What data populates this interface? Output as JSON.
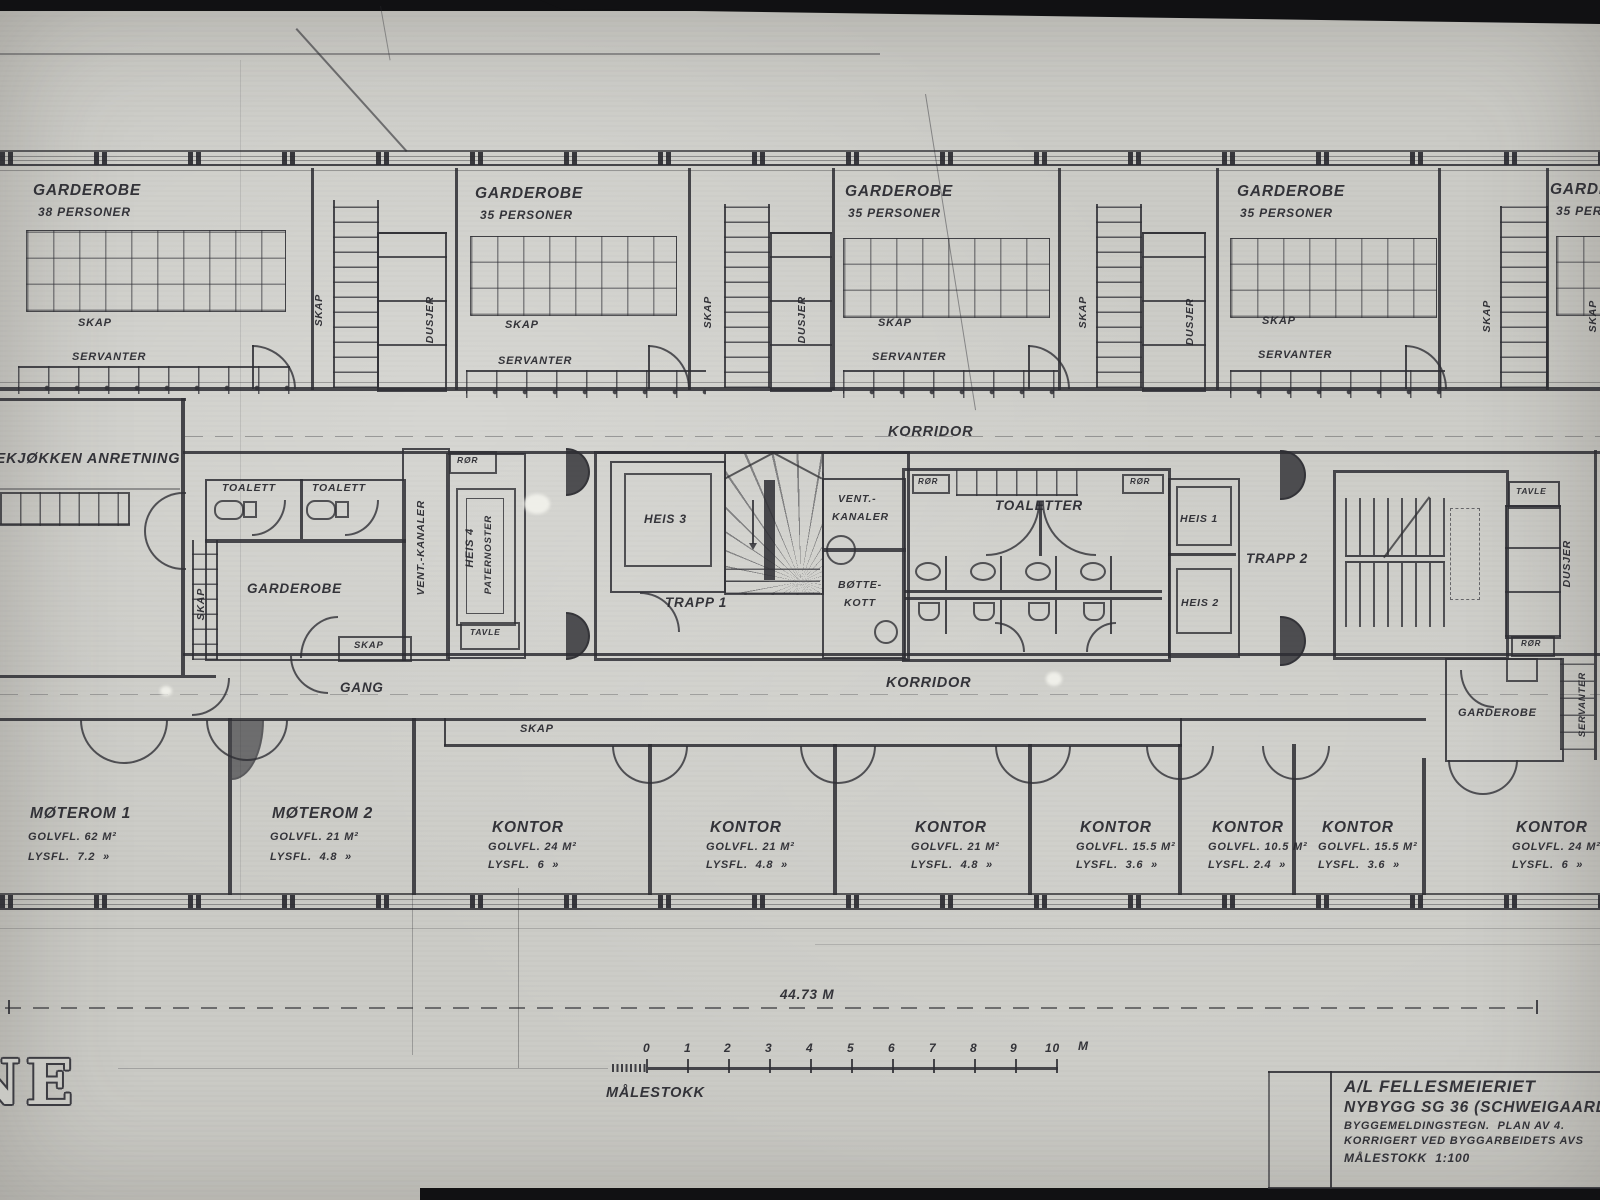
{
  "page": {
    "bg": "#cbcbc6",
    "ink": "#2f2f35"
  },
  "upper_band": {
    "rooms": [
      {
        "name": "GARDEROBE",
        "persons": "38 PERSONER",
        "skap": "SKAP",
        "servanter": "SERVANTER"
      },
      {
        "name": "GARDEROBE",
        "persons": "35 PERSONER",
        "skap": "SKAP",
        "servanter": "SERVANTER"
      },
      {
        "name": "GARDEROBE",
        "persons": "35 PERSONER",
        "skap": "SKAP",
        "servanter": "SERVANTER"
      },
      {
        "name": "GARDEROBE",
        "persons": "35 PERSONER",
        "skap": "SKAP",
        "servanter": "SERVANTER"
      },
      {
        "name": "GARDEROBE",
        "persons": "35 PERSONER"
      }
    ],
    "strip_skap": "SKAP",
    "strip_dusjer": "DUSJER"
  },
  "corridors": {
    "top": "KORRIDOR",
    "bottom": "KORRIDOR",
    "gang": "GANG",
    "skap_band": "SKAP"
  },
  "core": {
    "tekjokken": "TEKJØKKEN ANRETNING",
    "toalett": "TOALETT",
    "garderobe": "GARDEROBE",
    "skap_vertical": "SKAP",
    "skap_small": "SKAP",
    "vent_kanaler_v": "VENT.-KANALER",
    "ror": "RØR",
    "tavle": "TAVLE",
    "heis4_line1": "HEIS 4",
    "heis4_line2": "PATERNOSTER",
    "heis3": "HEIS 3",
    "trapp1": "TRAPP 1",
    "vent2_line1": "VENT.-",
    "vent2_line2": "KANALER",
    "bottekott_line1": "BØTTE-",
    "bottekott_line2": "KOTT",
    "toaletter": "TOALETTER",
    "heis1": "HEIS 1",
    "heis2": "HEIS 2",
    "trapp2": "TRAPP 2",
    "dusjer_v": "DUSJER",
    "servanter_v": "SERVANTER",
    "garderobe_right": "GARDEROBE"
  },
  "lower_rooms": [
    {
      "name": "MØTEROM 1",
      "golvfl": "GOLVFL. 62 M²",
      "lysfl": "LYSFL.  7.2  »"
    },
    {
      "name": "MØTEROM 2",
      "golvfl": "GOLVFL. 21 M²",
      "lysfl": "LYSFL.  4.8  »"
    },
    {
      "name": "KONTOR",
      "golvfl": "GOLVFL. 24 M²",
      "lysfl": "LYSFL.  6  »"
    },
    {
      "name": "KONTOR",
      "golvfl": "GOLVFL. 21 M²",
      "lysfl": "LYSFL.  4.8  »"
    },
    {
      "name": "KONTOR",
      "golvfl": "GOLVFL. 21 M²",
      "lysfl": "LYSFL.  4.8  »"
    },
    {
      "name": "KONTOR",
      "golvfl": "GOLVFL. 15.5 M²",
      "lysfl": "LYSFL.  3.6  »"
    },
    {
      "name": "KONTOR",
      "golvfl": "GOLVFL. 10.5 M²",
      "lysfl": "LYSFL. 2.4  »"
    },
    {
      "name": "KONTOR",
      "golvfl": "GOLVFL. 15.5 M²",
      "lysfl": "LYSFL.  3.6  »"
    },
    {
      "name": "KONTOR",
      "golvfl": "GOLVFL. 24 M²",
      "lysfl": "LYSFL.  6  »"
    }
  ],
  "dimension_text": "44.73 M",
  "scale_bar": {
    "ticks": [
      "0",
      "1",
      "2",
      "3",
      "4",
      "5",
      "6",
      "7",
      "8",
      "9",
      "10"
    ],
    "unit": "M",
    "label": "MÅLESTOKK"
  },
  "title_block": {
    "line1": "A/L FELLESMEIERIET",
    "line2": "NYBYGG SG 36 (SCHWEIGAARDS GT.",
    "line3": "BYGGEMELDINGSTEGN.  PLAN AV 4.",
    "line4": "KORRIGERT VED BYGGARBEIDETS AVS",
    "line5": "MÅLESTOKK  1:100"
  },
  "corner_text": "NE"
}
